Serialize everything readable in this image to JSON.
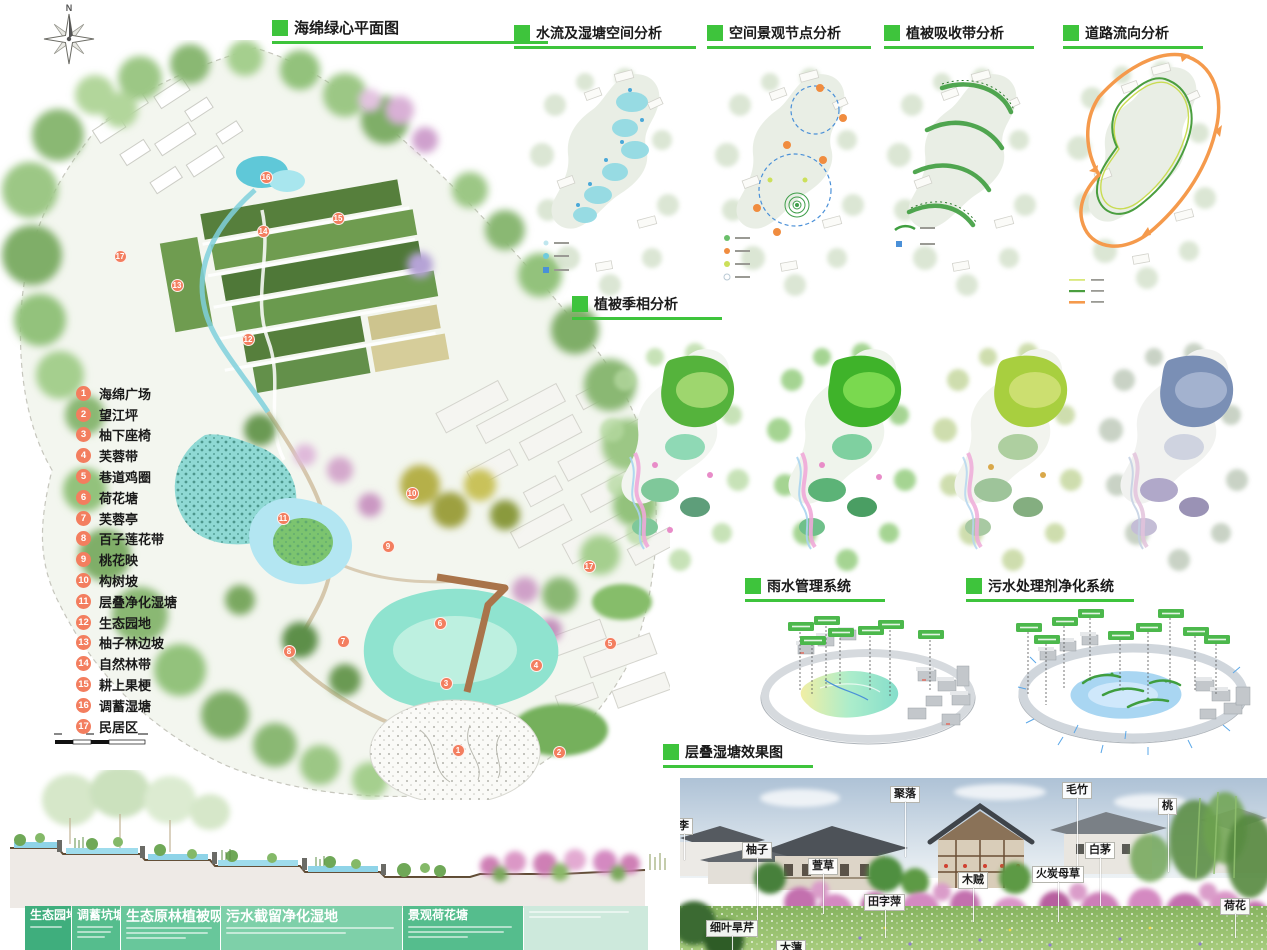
{
  "colors": {
    "accent_green": "#3ec43c",
    "marker_red": "#f37e5f",
    "water_cyan": "#8fd9e3",
    "road_orange": "#f59a4c",
    "pill_green": "#4cb84c"
  },
  "titles": {
    "main": "海绵绿心平面图",
    "water": "水流及湿塘空间分析",
    "nodes": "空间景观节点分析",
    "vegetation": "植被吸收带分析",
    "roads": "道路流向分析",
    "seasonal": "植被季相分析",
    "rain": "雨水管理系统",
    "sewage": "污水处理剂净化系统",
    "render": "层叠湿塘效果图"
  },
  "compass": {
    "north_label": "N"
  },
  "plan": {
    "legend": [
      {
        "num": "1",
        "label": "海绵广场"
      },
      {
        "num": "2",
        "label": "望江坪"
      },
      {
        "num": "3",
        "label": "柚下座椅"
      },
      {
        "num": "4",
        "label": "芙蓉带"
      },
      {
        "num": "5",
        "label": "巷道鸡圈"
      },
      {
        "num": "6",
        "label": "荷花塘"
      },
      {
        "num": "7",
        "label": "芙蓉亭"
      },
      {
        "num": "8",
        "label": "百子莲花带"
      },
      {
        "num": "9",
        "label": "桃花映"
      },
      {
        "num": "10",
        "label": "构树坡"
      },
      {
        "num": "11",
        "label": "层叠净化湿塘"
      },
      {
        "num": "12",
        "label": "生态园地"
      },
      {
        "num": "13",
        "label": "柚子林边坡"
      },
      {
        "num": "14",
        "label": "自然林带"
      },
      {
        "num": "15",
        "label": "耕上果梗"
      },
      {
        "num": "16",
        "label": "调蓄湿塘"
      },
      {
        "num": "17",
        "label": "民居区"
      }
    ],
    "markers": [
      {
        "n": "16",
        "x": 266,
        "y": 137
      },
      {
        "n": "15",
        "x": 338,
        "y": 178
      },
      {
        "n": "14",
        "x": 263,
        "y": 191
      },
      {
        "n": "17",
        "x": 120,
        "y": 216
      },
      {
        "n": "13",
        "x": 177,
        "y": 245
      },
      {
        "n": "12",
        "x": 248,
        "y": 299
      },
      {
        "n": "10",
        "x": 412,
        "y": 453
      },
      {
        "n": "11",
        "x": 283,
        "y": 478
      },
      {
        "n": "9",
        "x": 388,
        "y": 506
      },
      {
        "n": "17",
        "x": 589,
        "y": 526
      },
      {
        "n": "6",
        "x": 440,
        "y": 583
      },
      {
        "n": "7",
        "x": 343,
        "y": 601
      },
      {
        "n": "8",
        "x": 289,
        "y": 611
      },
      {
        "n": "5",
        "x": 610,
        "y": 603
      },
      {
        "n": "4",
        "x": 536,
        "y": 625
      },
      {
        "n": "3",
        "x": 446,
        "y": 643
      },
      {
        "n": "1",
        "x": 458,
        "y": 710
      },
      {
        "n": "2",
        "x": 559,
        "y": 712
      }
    ]
  },
  "photo": {
    "labels": [
      {
        "text": "李",
        "x": -6,
        "y": 40,
        "lead": 26
      },
      {
        "text": "柚子",
        "x": 62,
        "y": 64,
        "lead": 62
      },
      {
        "text": "聚落",
        "x": 210,
        "y": 8,
        "lead": 55
      },
      {
        "text": "毛竹",
        "x": 382,
        "y": 4,
        "lead": 74
      },
      {
        "text": "桃",
        "x": 478,
        "y": 20,
        "lead": 58
      },
      {
        "text": "白茅",
        "x": 405,
        "y": 64,
        "lead": 48
      },
      {
        "text": "萱草",
        "x": 128,
        "y": 80,
        "lead": 40
      },
      {
        "text": "木贼",
        "x": 278,
        "y": 94,
        "lead": 34
      },
      {
        "text": "火炭母草",
        "x": 352,
        "y": 88,
        "lead": 40
      },
      {
        "text": "田字萍",
        "x": 184,
        "y": 116,
        "lead": 28
      },
      {
        "text": "细叶旱芹",
        "x": 26,
        "y": 142,
        "lead": 18
      },
      {
        "text": "大薸",
        "x": 96,
        "y": 162,
        "lead": 0
      },
      {
        "text": "荷花",
        "x": 540,
        "y": 120,
        "lead": 24
      }
    ]
  },
  "eco_table": {
    "cells": [
      {
        "title": "生态园地",
        "color": "#3fae7d",
        "w": 46,
        "wide": false,
        "lines": [
          32
        ]
      },
      {
        "title": "调蓄坑塘",
        "color": "#55bd8d",
        "w": 48,
        "wide": false,
        "lines": [
          36,
          34,
          28
        ]
      },
      {
        "title": "生态原林植被吸收带",
        "color": "#68c79b",
        "w": 99,
        "wide": true,
        "lines": [
          86,
          82,
          60
        ]
      },
      {
        "title": "污水截留净化湿地",
        "color": "#7ed0a9",
        "w": 181,
        "wide": true,
        "lines": [
          168,
          120
        ]
      },
      {
        "title": "景观荷花塘",
        "color": "#55bd8d",
        "w": 120,
        "wide": false,
        "lines": [
          104,
          96,
          60
        ]
      },
      {
        "title": "",
        "color": "#cde9dc",
        "w": 124,
        "wide": false,
        "lines": [
          100,
          72
        ]
      }
    ]
  }
}
